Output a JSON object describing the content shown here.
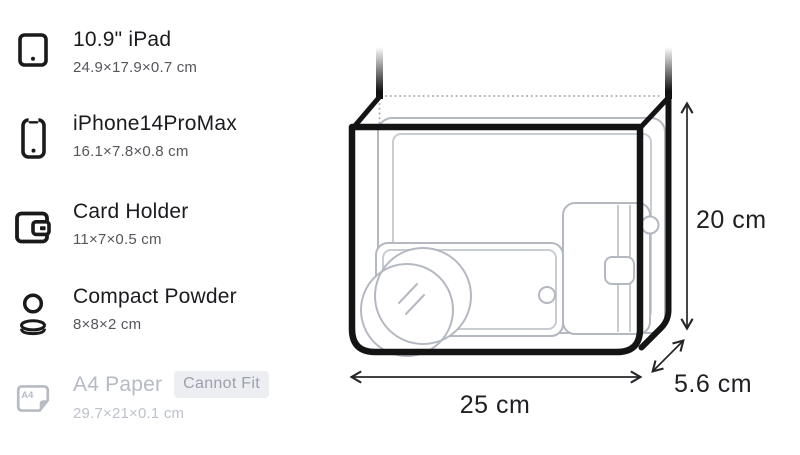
{
  "item_list": {
    "items": [
      {
        "name": "10.9\" iPad",
        "dimensions": "24.9×17.9×0.7 cm",
        "icon": "tablet-icon",
        "fits": true
      },
      {
        "name": "iPhone14ProMax",
        "dimensions": "16.1×7.8×0.8 cm",
        "icon": "smartphone-icon",
        "fits": true
      },
      {
        "name": "Card Holder",
        "dimensions": "11×7×0.5 cm",
        "icon": "wallet-icon",
        "fits": true
      },
      {
        "name": "Compact Powder",
        "dimensions": "8×8×2 cm",
        "icon": "compact-powder-icon",
        "fits": true
      },
      {
        "name": "A4 Paper",
        "dimensions": "29.7×21×0.1 cm",
        "icon": "a4-paper-icon",
        "fits": false,
        "badge": "Cannot Fit",
        "icon_label": "A4"
      }
    ]
  },
  "bag_diagram": {
    "width_label": "25 cm",
    "height_label": "20 cm",
    "depth_label": "5.6 cm"
  },
  "colors": {
    "text_primary": "#1b1b1f",
    "text_secondary": "#56565c",
    "disabled_text": "#b5bac4",
    "badge_background": "#edeef2",
    "badge_text": "#9aa0ab",
    "bag_outline": "#141414",
    "item_outline": "#b4b8c1",
    "dimension_text": "#202024"
  }
}
